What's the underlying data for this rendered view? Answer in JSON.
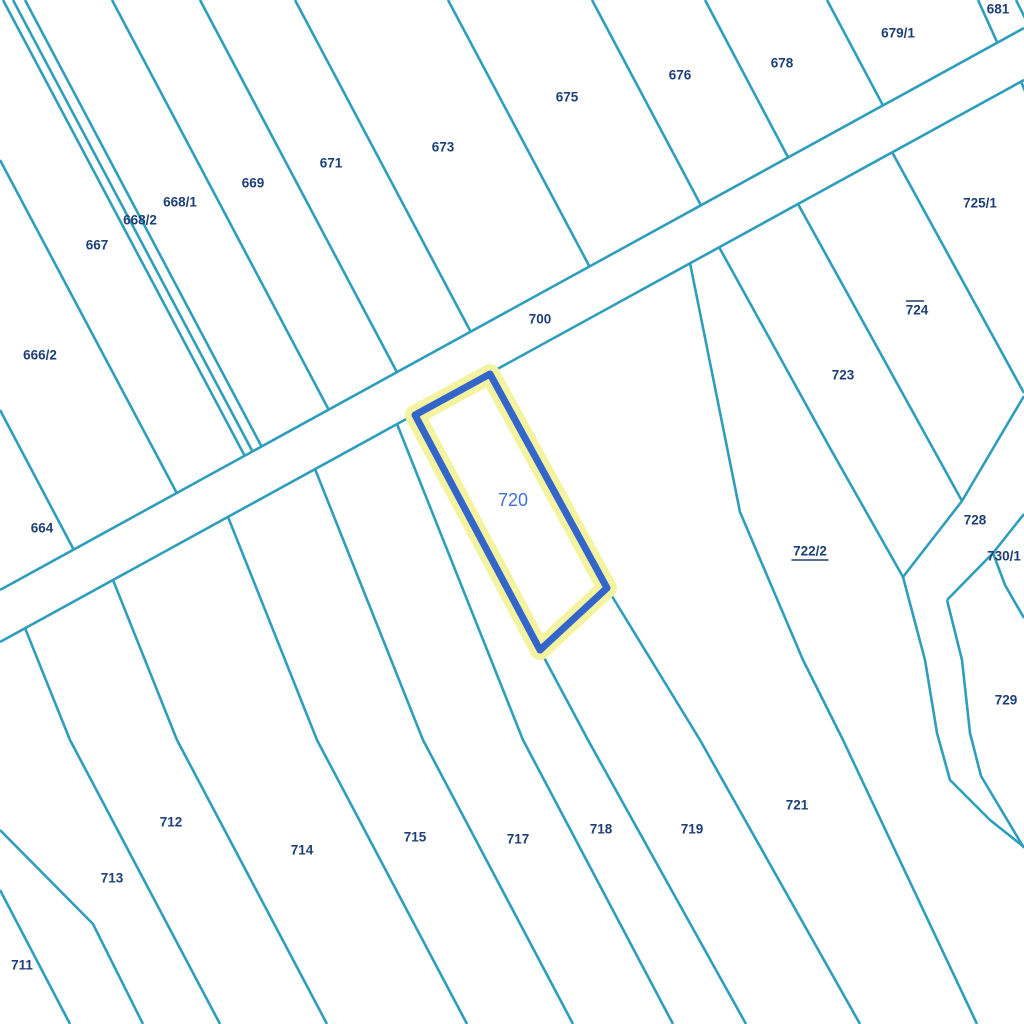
{
  "map": {
    "title": "cadastral-parcel-map",
    "background": "#ffffff",
    "colors": {
      "boundary": "#2E9EBC",
      "label": "#1E4076",
      "highlight_halo": "#F3F3A0",
      "highlight_stroke": "#3365CB",
      "highlight_label": "#4070D6"
    },
    "line_width": 2.6,
    "label_font_size": 13.5,
    "road": {
      "label": "700",
      "label_x": 540,
      "label_y": 319,
      "upper": [
        [
          0,
          590
        ],
        [
          1024,
          28
        ]
      ],
      "lower": [
        [
          0,
          642
        ],
        [
          1024,
          80
        ]
      ]
    },
    "boundaries": [
      {
        "name": "boundary-n1",
        "points": [
          [
            3,
            0
          ],
          [
            266,
            496
          ]
        ]
      },
      {
        "name": "boundary-n2",
        "points": [
          [
            13,
            0
          ],
          [
            274,
            492
          ]
        ]
      },
      {
        "name": "boundary-n3",
        "points": [
          [
            25,
            0
          ],
          [
            283,
            487
          ]
        ]
      },
      {
        "name": "boundary-n4",
        "points": [
          [
            112,
            0
          ],
          [
            350,
            450
          ]
        ]
      },
      {
        "name": "boundary-n5",
        "points": [
          [
            200,
            0
          ],
          [
            418,
            412
          ]
        ]
      },
      {
        "name": "boundary-n6",
        "points": [
          [
            295,
            0
          ],
          [
            492,
            372
          ]
        ]
      },
      {
        "name": "boundary-n7",
        "points": [
          [
            448,
            0
          ],
          [
            611,
            307
          ]
        ]
      },
      {
        "name": "boundary-n8",
        "points": [
          [
            592,
            0
          ],
          [
            722,
            245
          ]
        ]
      },
      {
        "name": "boundary-n9",
        "points": [
          [
            705,
            0
          ],
          [
            809,
            197
          ]
        ]
      },
      {
        "name": "boundary-n10",
        "points": [
          [
            827,
            0
          ],
          [
            904,
            145
          ]
        ]
      },
      {
        "name": "boundary-n11",
        "points": [
          [
            978,
            0
          ],
          [
            1016,
            84
          ]
        ]
      },
      {
        "name": "boundary-n12",
        "points": [
          [
            1016,
            0
          ],
          [
            1030,
            28
          ]
        ]
      },
      {
        "name": "boundary-nw-left1",
        "points": [
          [
            0,
            160
          ],
          [
            198,
            533
          ]
        ]
      },
      {
        "name": "boundary-nw-left2",
        "points": [
          [
            0,
            410
          ],
          [
            95,
            590
          ]
        ]
      },
      {
        "name": "boundary-s0",
        "points": [
          [
            0,
            890
          ],
          [
            70,
            1024
          ]
        ]
      },
      {
        "name": "boundary-s0b",
        "points": [
          [
            0,
            830
          ],
          [
            93,
            924
          ],
          [
            143,
            1024
          ]
        ]
      },
      {
        "name": "boundary-s1",
        "points": [
          [
            25,
            628
          ],
          [
            70,
            740
          ],
          [
            220,
            1024
          ]
        ]
      },
      {
        "name": "boundary-s2",
        "points": [
          [
            113,
            580
          ],
          [
            177,
            740
          ],
          [
            327,
            1024
          ]
        ]
      },
      {
        "name": "boundary-s3",
        "points": [
          [
            228,
            517
          ],
          [
            317,
            740
          ],
          [
            467,
            1024
          ]
        ]
      },
      {
        "name": "boundary-s4",
        "points": [
          [
            315,
            469
          ],
          [
            423,
            740
          ],
          [
            573,
            1024
          ]
        ]
      },
      {
        "name": "boundary-s5",
        "points": [
          [
            397,
            424
          ],
          [
            523,
            740
          ],
          [
            673,
            1024
          ]
        ]
      },
      {
        "name": "boundary-s6",
        "points": [
          [
            540,
            650
          ],
          [
            588,
            740
          ],
          [
            746,
            1024
          ]
        ]
      },
      {
        "name": "boundary-s7",
        "points": [
          [
            607,
            588
          ],
          [
            700,
            740
          ],
          [
            860,
            1024
          ]
        ]
      },
      {
        "name": "boundary-s8",
        "points": [
          [
            690,
            263
          ],
          [
            740,
            512
          ],
          [
            803,
            660
          ],
          [
            843,
            740
          ],
          [
            977,
            1024
          ]
        ]
      },
      {
        "name": "boundary-722-723",
        "points": [
          [
            719,
            247
          ],
          [
            830,
            448
          ],
          [
            903,
            577
          ]
        ]
      },
      {
        "name": "boundary-corridor-left",
        "points": [
          [
            903,
            577
          ],
          [
            925,
            660
          ],
          [
            937,
            733
          ],
          [
            950,
            780
          ],
          [
            990,
            820
          ],
          [
            1024,
            847
          ]
        ]
      },
      {
        "name": "boundary-corridor-right",
        "points": [
          [
            947,
            600
          ],
          [
            962,
            660
          ],
          [
            970,
            733
          ],
          [
            981,
            776
          ],
          [
            1024,
            848
          ]
        ]
      },
      {
        "name": "boundary-723-728",
        "points": [
          [
            903,
            577
          ],
          [
            962,
            501
          ],
          [
            1024,
            396
          ]
        ]
      },
      {
        "name": "boundary-723-724",
        "points": [
          [
            798,
            204
          ],
          [
            962,
            501
          ]
        ]
      },
      {
        "name": "boundary-724-725",
        "points": [
          [
            892,
            152
          ],
          [
            1024,
            393
          ]
        ]
      },
      {
        "name": "boundary-728-730",
        "points": [
          [
            947,
            600
          ],
          [
            993,
            553
          ],
          [
            1024,
            514
          ]
        ]
      },
      {
        "name": "boundary-730-729",
        "points": [
          [
            993,
            553
          ],
          [
            1005,
            585
          ],
          [
            1024,
            618
          ]
        ]
      },
      {
        "name": "boundary-corner-sliver",
        "points": [
          [
            1018,
            74
          ],
          [
            1027,
            96
          ]
        ]
      }
    ],
    "highlight_parcel": {
      "number": "720",
      "points": [
        [
          490,
          374
        ],
        [
          607,
          588
        ],
        [
          540,
          650
        ],
        [
          415,
          415
        ]
      ],
      "label_x": 513,
      "label_y": 500,
      "label_font_size": 18
    },
    "parcels": [
      {
        "number": "664",
        "x": 42,
        "y": 528,
        "deco": "none"
      },
      {
        "number": "666/2",
        "x": 40,
        "y": 355,
        "deco": "none"
      },
      {
        "number": "667",
        "x": 97,
        "y": 245,
        "deco": "none"
      },
      {
        "number": "668/2",
        "x": 140,
        "y": 220,
        "deco": "none"
      },
      {
        "number": "668/1",
        "x": 180,
        "y": 202,
        "deco": "none"
      },
      {
        "number": "669",
        "x": 253,
        "y": 183,
        "deco": "none"
      },
      {
        "number": "671",
        "x": 331,
        "y": 163,
        "deco": "none"
      },
      {
        "number": "673",
        "x": 443,
        "y": 147,
        "deco": "none"
      },
      {
        "number": "675",
        "x": 567,
        "y": 97,
        "deco": "none"
      },
      {
        "number": "676",
        "x": 680,
        "y": 75,
        "deco": "none"
      },
      {
        "number": "678",
        "x": 782,
        "y": 63,
        "deco": "none"
      },
      {
        "number": "679/1",
        "x": 898,
        "y": 33,
        "deco": "none"
      },
      {
        "number": "681",
        "x": 998,
        "y": 9,
        "deco": "none"
      },
      {
        "number": "723",
        "x": 843,
        "y": 375,
        "deco": "none"
      },
      {
        "number": "724",
        "x": 917,
        "y": 310,
        "deco": "overline"
      },
      {
        "number": "725/1",
        "x": 980,
        "y": 203,
        "deco": "none"
      },
      {
        "number": "722/2",
        "x": 810,
        "y": 551,
        "deco": "underline"
      },
      {
        "number": "728",
        "x": 975,
        "y": 520,
        "deco": "none"
      },
      {
        "number": "730/1",
        "x": 1004,
        "y": 556,
        "deco": "none"
      },
      {
        "number": "729",
        "x": 1006,
        "y": 700,
        "deco": "none"
      },
      {
        "number": "721",
        "x": 797,
        "y": 805,
        "deco": "none"
      },
      {
        "number": "719",
        "x": 692,
        "y": 829,
        "deco": "none"
      },
      {
        "number": "718",
        "x": 601,
        "y": 829,
        "deco": "none"
      },
      {
        "number": "717",
        "x": 518,
        "y": 839,
        "deco": "none"
      },
      {
        "number": "715",
        "x": 415,
        "y": 837,
        "deco": "none"
      },
      {
        "number": "714",
        "x": 302,
        "y": 850,
        "deco": "none"
      },
      {
        "number": "712",
        "x": 171,
        "y": 822,
        "deco": "none"
      },
      {
        "number": "713",
        "x": 112,
        "y": 878,
        "deco": "none"
      },
      {
        "number": "711",
        "x": 22,
        "y": 965,
        "deco": "none"
      }
    ]
  }
}
